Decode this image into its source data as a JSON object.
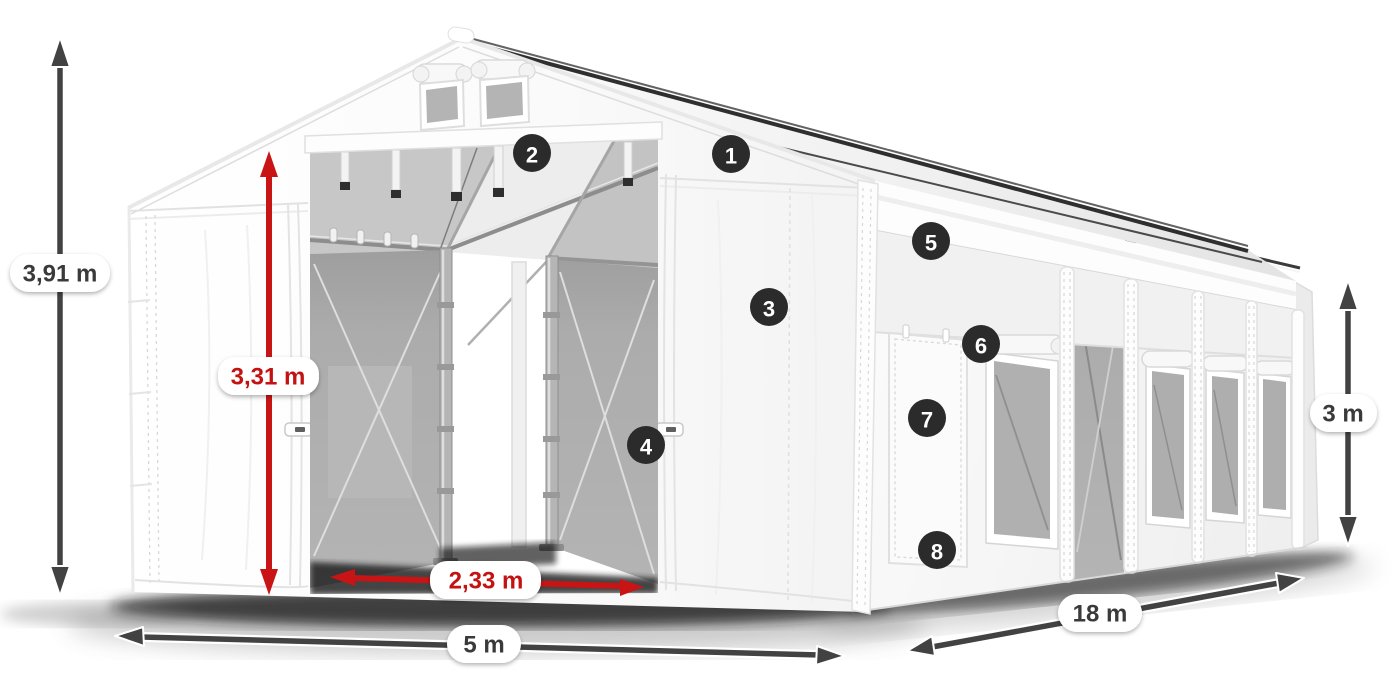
{
  "page": {
    "background": "#ffffff",
    "subject": "White storage marquee tent 5x18 m shown in perspective with dimension arrows and numbered feature callouts"
  },
  "colors": {
    "arrow_dark": "#424242",
    "arrow_red": "#c81414",
    "label_text_dark": "#3a3a3a",
    "label_text_red": "#c41111",
    "label_pill_bg": "#ffffff",
    "badge_bg": "#2b2b2b",
    "badge_text": "#ffffff",
    "tent_white": "#fcfcfc",
    "mesh_gray": "#a9a9a9"
  },
  "measurements": {
    "total_height": {
      "label": "3,91 m",
      "style": "dark",
      "orientation": "vertical",
      "position": "far-left"
    },
    "entrance_height": {
      "label": "3,31 m",
      "style": "red",
      "orientation": "vertical",
      "position": "front-entrance"
    },
    "entrance_width": {
      "label": "2,33 m",
      "style": "red",
      "orientation": "horizontal",
      "position": "front-entrance"
    },
    "front_width": {
      "label": "5 m",
      "style": "dark",
      "orientation": "horizontal",
      "position": "bottom-front"
    },
    "side_length": {
      "label": "18 m",
      "style": "dark",
      "orientation": "diagonal",
      "position": "bottom-right"
    },
    "side_wall_height": {
      "label": "3 m",
      "style": "dark",
      "orientation": "vertical",
      "position": "far-right"
    }
  },
  "callouts": [
    {
      "number": "1",
      "target": "roof"
    },
    {
      "number": "2",
      "target": "roof-frame-interior"
    },
    {
      "number": "3",
      "target": "front-wall"
    },
    {
      "number": "4",
      "target": "front-door-edge"
    },
    {
      "number": "5",
      "target": "side-upper-panel"
    },
    {
      "number": "6",
      "target": "side-window-roll-bar"
    },
    {
      "number": "7",
      "target": "side-door"
    },
    {
      "number": "8",
      "target": "side-door-bottom"
    }
  ]
}
